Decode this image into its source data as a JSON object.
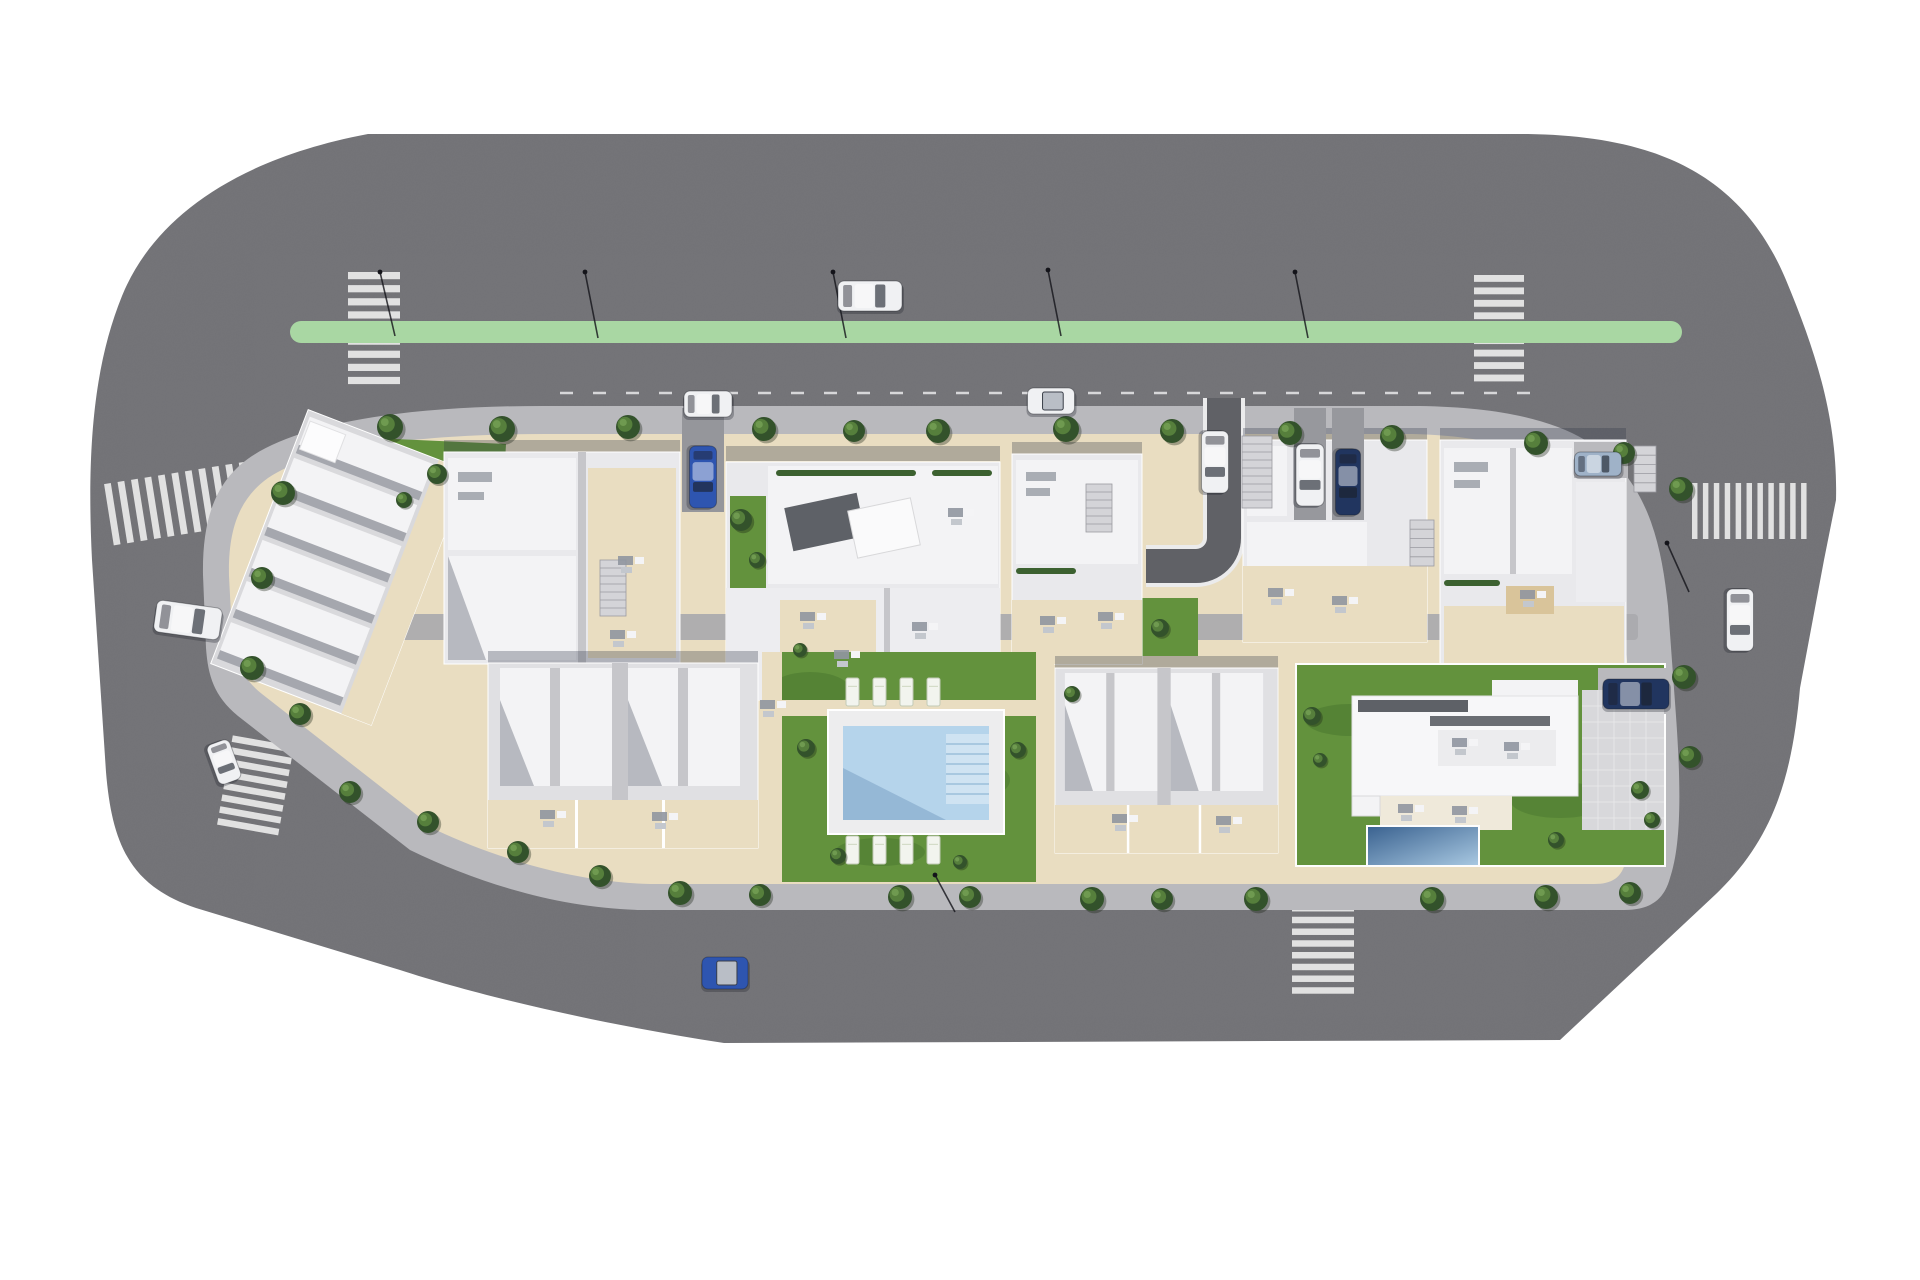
{
  "scene": {
    "description": "Aerial 3D architect render of a residential urban block: apartment buildings, terraced houses, duplexes, communal pool garden, detached villa with private pool, surrounding asphalt roads with green cycle lane, zebra crossings, street trees, street lamps and cars",
    "background": "#ffffff"
  },
  "colors": {
    "asphalt": "#727276",
    "asphalt_dark": "#606166",
    "green_lane": "#a9d7a3",
    "stripe": "#e9e9ea",
    "curb": "#ebebec",
    "sidewalk": "#b9b9bd",
    "walkway": "#a9a9ae",
    "beige": "#e9ddc1",
    "grass": "#63923d",
    "grass_dark": "#44712c",
    "roof_light": "#e9e9ec",
    "roof_white": "#f3f3f5",
    "roof_mid": "#c6c6ca",
    "roof_dark": "#5e6167",
    "shadow": "rgba(47,53,70,0.30)",
    "pool_deck": "#ededee",
    "pool_water": "#b5d4eb",
    "pool_water_dark": "#8fb3d2",
    "pool_steps": "#cfe3f2",
    "villa_pool_dark": "#39618f",
    "villa_pool_light": "#a9c9e2",
    "car_white": "#f0f1f3",
    "car_blue": "#2e55b0",
    "car_navy": "#21355f",
    "car_silver": "#9fb2c8",
    "tree_dark": "#33522b",
    "tree_mid": "#567f3c",
    "tree_light": "#6f9a50",
    "lamp": "#14141a"
  },
  "green_lane": {
    "x": 290,
    "y": 321,
    "width": 1392,
    "height": 22,
    "radius": 11
  },
  "parking_line": {
    "x1": 560,
    "y": 393,
    "x2": 1540,
    "dash": "13 20"
  },
  "crosswalks": [
    {
      "id": "crosswalk-top-left",
      "x": 348,
      "y": 272,
      "width": 52,
      "height": 118,
      "stripes": 9,
      "bars": "horizontal",
      "angle": 0
    },
    {
      "id": "crosswalk-top-right",
      "x": 1474,
      "y": 275,
      "width": 50,
      "height": 112,
      "stripes": 9,
      "bars": "horizontal",
      "angle": 0
    },
    {
      "id": "crosswalk-left",
      "x": 108,
      "y": 472,
      "width": 150,
      "height": 62,
      "stripes": 11,
      "bars": "vertical",
      "angle": -9
    },
    {
      "id": "crosswalk-right",
      "x": 1692,
      "y": 483,
      "width": 120,
      "height": 56,
      "stripes": 11,
      "bars": "vertical",
      "angle": 0
    },
    {
      "id": "crosswalk-bottom-left",
      "x": 224,
      "y": 740,
      "width": 62,
      "height": 96,
      "stripes": 8,
      "bars": "horizontal",
      "angle": 10
    },
    {
      "id": "crosswalk-bottom-right",
      "x": 1292,
      "y": 905,
      "width": 62,
      "height": 94,
      "stripes": 8,
      "bars": "horizontal",
      "angle": 0
    }
  ],
  "cars": [
    {
      "id": "car-white-driving-top-road",
      "color": "car_white",
      "cx": 870,
      "cy": 296,
      "length": 64,
      "width": 30,
      "angle": 0
    },
    {
      "id": "car-white-parked-top-lane",
      "color": "car_white",
      "cx": 708,
      "cy": 404,
      "length": 48,
      "width": 26,
      "angle": 0
    },
    {
      "id": "car-white-convertible-parked",
      "color": "car_white",
      "cx": 1051,
      "cy": 401,
      "length": 47,
      "width": 26,
      "angle": 0,
      "open": true
    },
    {
      "id": "car-blue-driveway",
      "color": "car_blue",
      "cx": 703,
      "cy": 477,
      "length": 62,
      "width": 27,
      "angle": 90
    },
    {
      "id": "car-white-curve-driveway",
      "color": "car_white",
      "cx": 1215,
      "cy": 462,
      "length": 62,
      "width": 27,
      "angle": 90
    },
    {
      "id": "car-white-van-driveway",
      "color": "car_white",
      "cx": 1310,
      "cy": 475,
      "length": 62,
      "width": 28,
      "angle": 90
    },
    {
      "id": "car-navy-suv-driveway",
      "color": "car_navy",
      "cx": 1348,
      "cy": 482,
      "length": 66,
      "width": 25,
      "angle": 90
    },
    {
      "id": "car-silver-parked-pad",
      "color": "car_silver",
      "cx": 1598,
      "cy": 464,
      "length": 47,
      "width": 24,
      "angle": 0
    },
    {
      "id": "car-navy-villa-pad",
      "color": "car_navy",
      "cx": 1636,
      "cy": 694,
      "length": 66,
      "width": 30,
      "angle": 0
    },
    {
      "id": "car-white-right-road",
      "color": "car_white",
      "cx": 1740,
      "cy": 620,
      "length": 62,
      "width": 27,
      "angle": 90
    },
    {
      "id": "car-blue-bottom-road",
      "color": "car_blue",
      "cx": 725,
      "cy": 973,
      "length": 46,
      "width": 32,
      "angle": 0,
      "open": true
    },
    {
      "id": "car-white-left-road",
      "color": "car_white",
      "cx": 188,
      "cy": 620,
      "length": 66,
      "width": 32,
      "angle": 8
    },
    {
      "id": "car-white-left-road-lower",
      "color": "car_white",
      "cx": 224,
      "cy": 762,
      "length": 42,
      "width": 24,
      "angle": 70
    }
  ],
  "trees": [
    [
      390,
      427,
      13
    ],
    [
      502,
      429,
      13
    ],
    [
      628,
      427,
      12
    ],
    [
      764,
      429,
      12
    ],
    [
      854,
      431,
      11
    ],
    [
      938,
      431,
      12
    ],
    [
      1066,
      429,
      13
    ],
    [
      1172,
      431,
      12
    ],
    [
      1290,
      433,
      12
    ],
    [
      1392,
      437,
      12
    ],
    [
      1536,
      443,
      12
    ],
    [
      1624,
      453,
      11
    ],
    [
      1681,
      489,
      12
    ],
    [
      1684,
      677,
      12
    ],
    [
      1690,
      757,
      11
    ],
    [
      680,
      893,
      12
    ],
    [
      760,
      895,
      11
    ],
    [
      900,
      897,
      12
    ],
    [
      970,
      897,
      11
    ],
    [
      1092,
      899,
      12
    ],
    [
      1162,
      899,
      11
    ],
    [
      1256,
      899,
      12
    ],
    [
      1432,
      899,
      12
    ],
    [
      1546,
      897,
      12
    ],
    [
      1630,
      893,
      11
    ],
    [
      350,
      792,
      11
    ],
    [
      428,
      822,
      11
    ],
    [
      518,
      852,
      11
    ],
    [
      600,
      876,
      11
    ],
    [
      300,
      714,
      11
    ],
    [
      252,
      668,
      12
    ],
    [
      283,
      493,
      12
    ],
    [
      262,
      578,
      11
    ],
    [
      437,
      474,
      10
    ],
    [
      404,
      500,
      8
    ],
    [
      741,
      520,
      11
    ],
    [
      757,
      560,
      8
    ],
    [
      806,
      748,
      9
    ],
    [
      1018,
      750,
      8
    ],
    [
      838,
      856,
      8
    ],
    [
      960,
      862,
      7
    ],
    [
      800,
      650,
      7
    ],
    [
      1312,
      716,
      9
    ],
    [
      1320,
      760,
      7
    ],
    [
      1640,
      790,
      9
    ],
    [
      1652,
      820,
      8
    ],
    [
      1556,
      840,
      8
    ],
    [
      1072,
      694,
      8
    ],
    [
      1160,
      628,
      9
    ]
  ],
  "lamps": [
    [
      585,
      272,
      598,
      338
    ],
    [
      833,
      272,
      846,
      338
    ],
    [
      1048,
      270,
      1061,
      336
    ],
    [
      1295,
      272,
      1308,
      338
    ],
    [
      380,
      272,
      395,
      336
    ],
    [
      1667,
      543,
      1689,
      592
    ],
    [
      935,
      875,
      955,
      912
    ]
  ],
  "stairs": [
    [
      600,
      560,
      26,
      56
    ],
    [
      1086,
      484,
      26,
      48
    ],
    [
      1410,
      520,
      24,
      46
    ],
    [
      1634,
      446,
      22,
      46
    ],
    [
      1242,
      436,
      30,
      72
    ]
  ],
  "hedges": [
    [
      776,
      470,
      140
    ],
    [
      932,
      470,
      60
    ],
    [
      1016,
      568,
      60
    ],
    [
      1444,
      580,
      56
    ]
  ],
  "furniture": [
    [
      610,
      630
    ],
    [
      618,
      556
    ],
    [
      800,
      612
    ],
    [
      834,
      650
    ],
    [
      912,
      622
    ],
    [
      948,
      508
    ],
    [
      1040,
      616
    ],
    [
      1098,
      612
    ],
    [
      1268,
      588
    ],
    [
      1332,
      596
    ],
    [
      1520,
      590
    ],
    [
      1452,
      738
    ],
    [
      1504,
      742
    ],
    [
      1398,
      804
    ],
    [
      1452,
      806
    ],
    [
      540,
      810
    ],
    [
      652,
      812
    ],
    [
      1112,
      814
    ],
    [
      1216,
      816
    ],
    [
      760,
      700
    ]
  ],
  "community_pool": {
    "deck": {
      "x": 828,
      "y": 710,
      "width": 176,
      "height": 124
    },
    "water": {
      "x": 843,
      "y": 726,
      "width": 146,
      "height": 94
    },
    "steps": {
      "x": 946,
      "y": 734,
      "width": 43,
      "height": 70,
      "lines": 6
    },
    "lounger_rows": [
      {
        "x": 846,
        "y": 678,
        "count": 4,
        "dx": 27,
        "w": 13,
        "h": 28
      },
      {
        "x": 846,
        "y": 836,
        "count": 4,
        "dx": 27,
        "w": 13,
        "h": 28
      }
    ]
  },
  "villa_pool": {
    "x": 1367,
    "y": 826,
    "width": 112,
    "height": 40
  },
  "buildings": [
    {
      "id": "building-terraced-houses",
      "type": "terraced houses, rotated block",
      "units": 6
    },
    {
      "id": "building-apartment-1",
      "type": "apartment block"
    },
    {
      "id": "building-apartment-2",
      "type": "large central apartment block"
    },
    {
      "id": "building-apartment-3",
      "type": "apartment block"
    },
    {
      "id": "building-apartment-4",
      "type": "apartment block with driveways"
    },
    {
      "id": "building-apartment-5",
      "type": "apartment block with roof terrace"
    },
    {
      "id": "building-duplex-left",
      "type": "duplex with patios",
      "units": 2
    },
    {
      "id": "building-duplex-right",
      "type": "duplex with patios",
      "units": 2
    },
    {
      "id": "building-villa",
      "type": "detached villa with private pool"
    }
  ]
}
